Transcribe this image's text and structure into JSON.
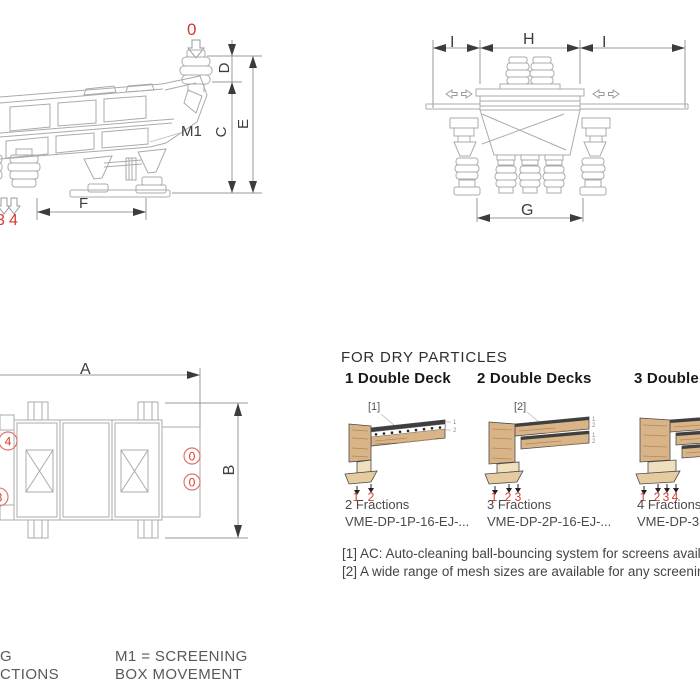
{
  "colors": {
    "accent_red": "#d6382e",
    "drawing_line": "#ababab",
    "dimension_text": "#3d3d3d",
    "wood_fill": "#d9b488"
  },
  "side_view": {
    "inlet_marker": "0",
    "outlet_markers": [
      "3",
      "4"
    ],
    "m1": "M1",
    "dims": {
      "d": "D",
      "c": "C",
      "e": "E",
      "f": "F"
    }
  },
  "front_view": {
    "dims": {
      "i_left": "I",
      "h": "H",
      "i_right": "I",
      "g": "G"
    }
  },
  "top_view": {
    "dims": {
      "a": "A",
      "b": "B"
    },
    "markers": {
      "left_top": "4",
      "left_bottom": "3",
      "right_top": "0",
      "right_bottom": "0"
    }
  },
  "dry": {
    "title": "FOR DRY PARTICLES",
    "decks": [
      {
        "title": "1 Double Deck",
        "note": "[1]",
        "outlets": [
          "1",
          "2"
        ],
        "side_marks": [
          "1",
          "2"
        ],
        "fractions": "2 Fractions",
        "model": "VME-DP-1P-16-EJ-..."
      },
      {
        "title": "2 Double Decks",
        "note": "[2]",
        "outlets": [
          "1",
          "2",
          "3"
        ],
        "side_marks": [
          "1",
          "2",
          "1",
          "2"
        ],
        "fractions": "3 Fractions",
        "model": "VME-DP-2P-16-EJ-..."
      },
      {
        "title": "3 Double Decks",
        "outlets": [
          "1",
          "2",
          "3",
          "4"
        ],
        "side_marks": [],
        "fractions": "4 Fractions",
        "model": "VME-DP-3P-1"
      }
    ],
    "footnotes": [
      "[1] AC: Auto-cleaning ball-bouncing system for screens availa",
      "[2] A wide range of mesh sizes are available for any screening"
    ]
  },
  "legend": {
    "left_fragment_1": "G",
    "left_fragment_2": "CTIONS",
    "m1_1": "M1 = SCREENING",
    "m1_2": "BOX MOVEMENT"
  }
}
